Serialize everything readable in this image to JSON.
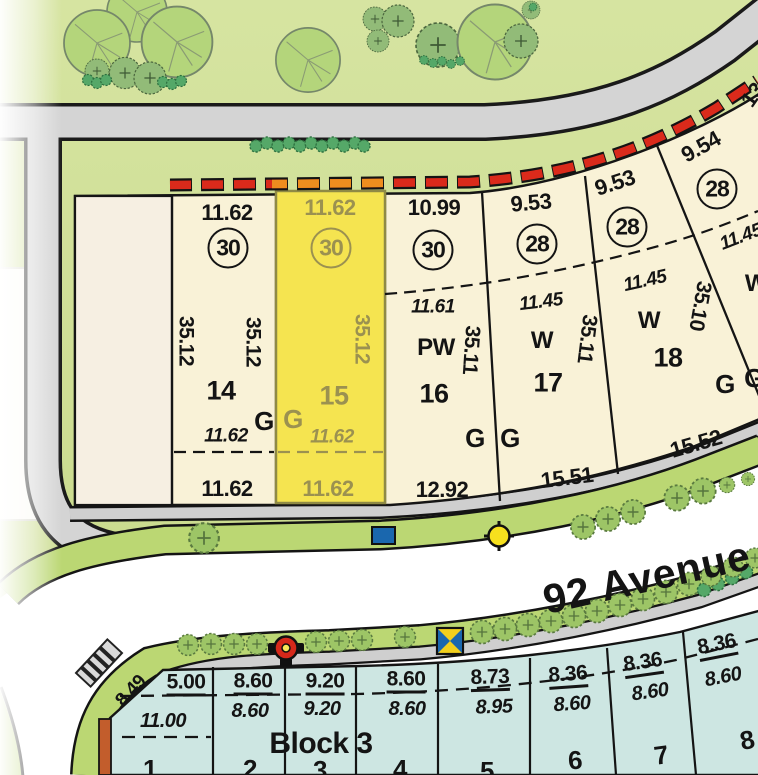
{
  "street": {
    "name": "92 Avenue"
  },
  "upper_block": {
    "corner_partial_dim": "13",
    "lots": [
      {
        "id": "14",
        "frontage": "11.62",
        "plan_circle": "30",
        "side_left": "35.12",
        "side_right": "35.12",
        "setback_depth": "11.62",
        "rear": "11.62",
        "garage": "G",
        "highlighted": false
      },
      {
        "id": "15",
        "frontage": "11.62",
        "plan_circle": "30",
        "side_right": "35.12",
        "setback_depth": "11.62",
        "rear": "11.62",
        "garage": "G",
        "highlighted": true
      },
      {
        "id": "16",
        "frontage": "10.99",
        "plan_circle": "30",
        "setback_depth": "11.61",
        "grade_code": "PW",
        "side_right": "35.11",
        "rear": "12.92",
        "garage": "G",
        "highlighted": false
      },
      {
        "id": "17",
        "frontage": "9.53",
        "plan_circle": "28",
        "setback_depth": "11.45",
        "grade_code": "W",
        "side_right": "35.11",
        "rear": "15.51",
        "garage": "G",
        "highlighted": false
      },
      {
        "id": "18",
        "frontage": "9.53",
        "plan_circle": "28",
        "setback_depth": "11.45",
        "grade_code": "W",
        "side_right": "35.10",
        "rear": "15.52",
        "garage": "G",
        "highlighted": false
      },
      {
        "id": "",
        "frontage": "9.54",
        "plan_circle": "28",
        "setback_depth": "11.45",
        "grade_code": "W",
        "garage": "G",
        "highlighted": false
      }
    ]
  },
  "block3": {
    "label": "Block 3",
    "lots": [
      {
        "number": "1",
        "width_top": "5.00",
        "width_mid": "11.00",
        "corner_diagonal": "8.49"
      },
      {
        "number": "2",
        "width_top": "8.60",
        "width_mid": "8.60"
      },
      {
        "number": "3",
        "width_top": "9.20",
        "width_mid": "9.20"
      },
      {
        "number": "4",
        "width_top": "8.60",
        "width_mid": "8.60"
      },
      {
        "number": "5",
        "width_top": "8.73",
        "width_mid": "8.95"
      },
      {
        "number": "6",
        "width_top": "8.36",
        "width_mid": "8.60"
      },
      {
        "number": "7",
        "width_top": "8.36",
        "width_mid": "8.60"
      },
      {
        "number": "8",
        "width_top": "8.36",
        "width_mid": "8.60"
      }
    ]
  },
  "colors": {
    "highlight_lot_yellow": "#f5e450",
    "lot_cream": "#f9f2d7",
    "block3_teal": "#cde6e2",
    "fence_dash_red": "#da2a1b",
    "fence_dash_orange": "#ee8d1f",
    "highlight_text_olive": "#9b9150"
  }
}
